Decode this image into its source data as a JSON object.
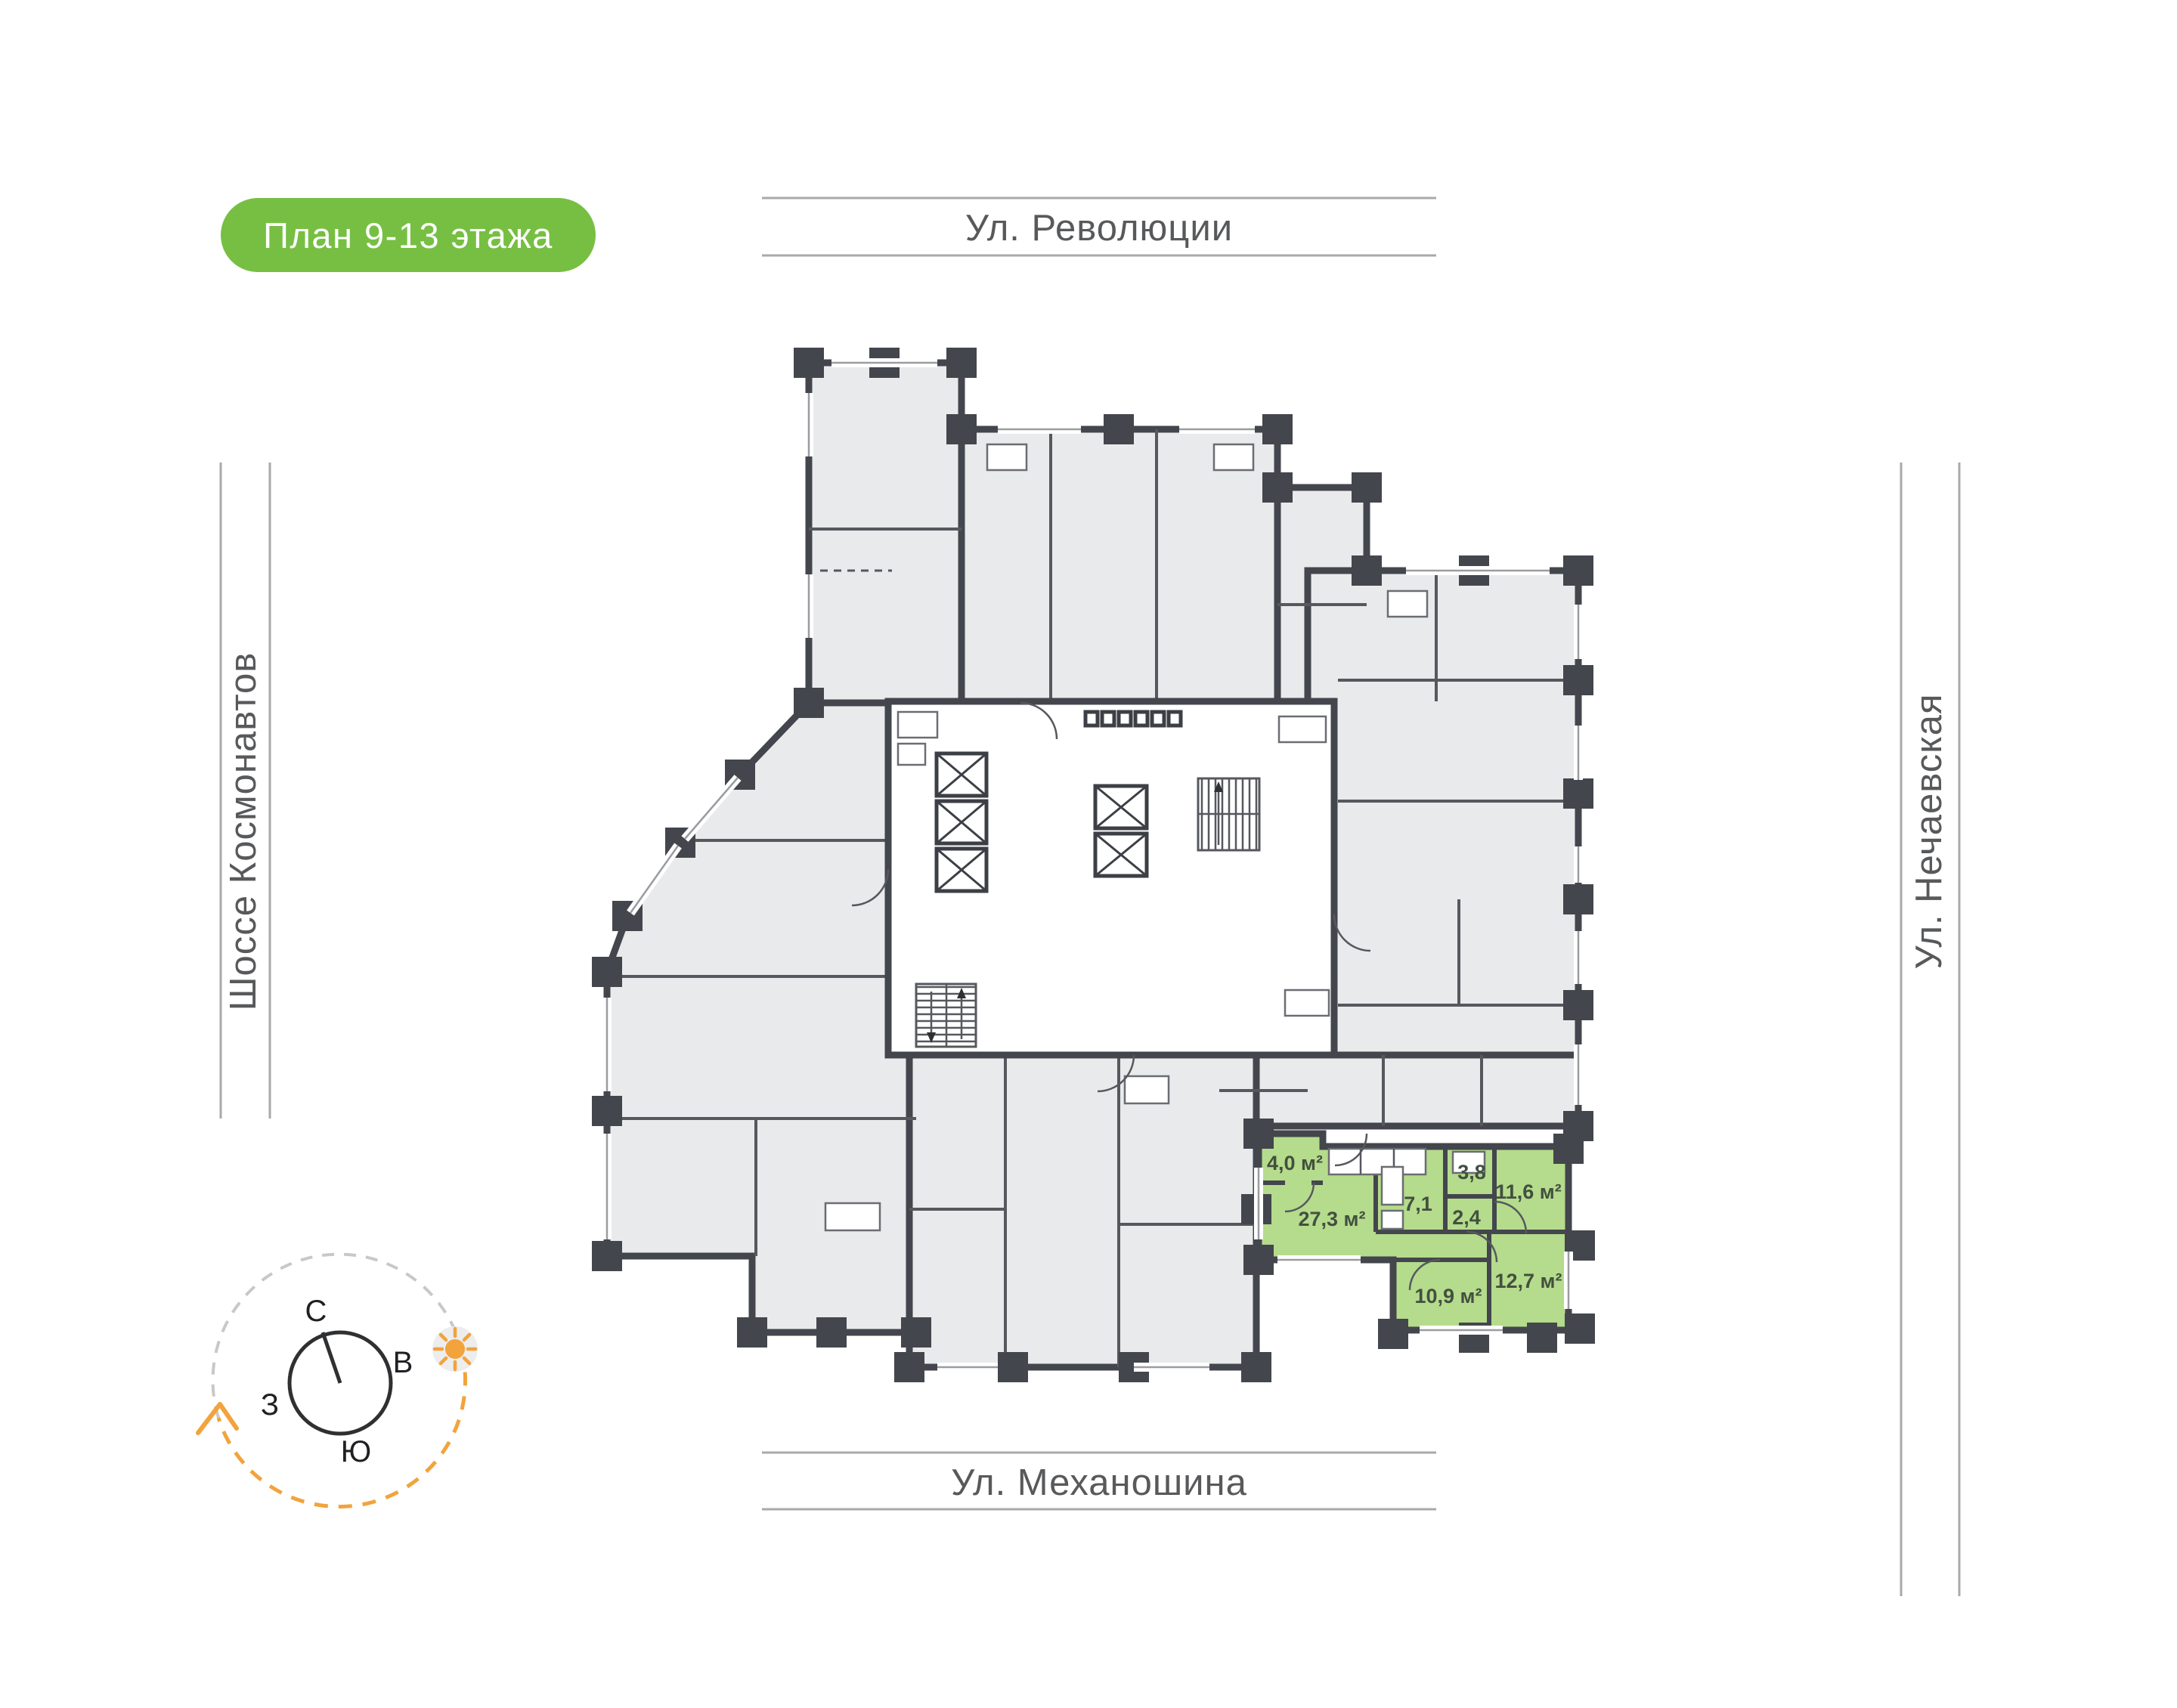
{
  "badge": {
    "label": "План 9-13 этажа"
  },
  "streets": {
    "top": "Ул. Революции",
    "bottom": "Ул. Механошина",
    "left": "Шоссе Космонавтов",
    "right": "Ул. Нечаевская"
  },
  "compass": {
    "north": "С",
    "south": "Ю",
    "west": "З",
    "east": "В"
  },
  "apartment": {
    "status": "highlighted",
    "rooms": [
      {
        "name": "hallway",
        "area": "4,0 м²"
      },
      {
        "name": "living-kitchen",
        "area": "27,3 м²"
      },
      {
        "name": "corridor",
        "area": "7,1"
      },
      {
        "name": "bathroom",
        "area": "3,8"
      },
      {
        "name": "wc",
        "area": "2,4"
      },
      {
        "name": "bedroom-1",
        "area": "11,6 м²"
      },
      {
        "name": "bedroom-2",
        "area": "10,9 м²"
      },
      {
        "name": "bedroom-3",
        "area": "12,7 м²"
      }
    ]
  },
  "colors": {
    "badge_bg": "#77BF43",
    "apartment_fill": "#B5DB8C",
    "wall": "#43464C",
    "room_fill": "#E9EAEB",
    "street_text": "#58595B",
    "accent_orange": "#F2A33C"
  }
}
